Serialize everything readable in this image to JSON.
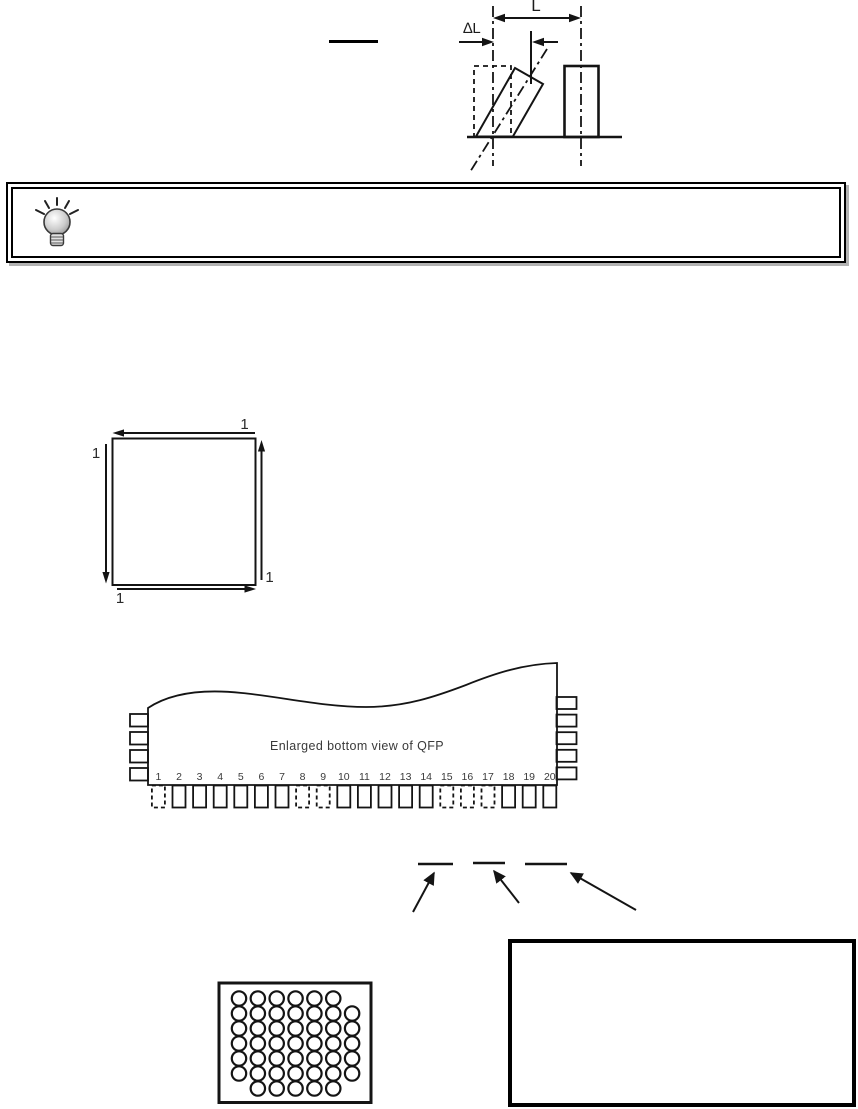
{
  "colors": {
    "ink": "#141414",
    "text": "#3a3a3a",
    "shadow": "#b3b3b3"
  },
  "figures": {
    "lead_deviation": {
      "dim_label_main": "L",
      "dim_label_delta": "∆L"
    },
    "blank_line": {
      "text": ""
    },
    "tip_box": {
      "icon": "lightbulb-icon",
      "text": ""
    },
    "sequence_square": {
      "corner_labels": {
        "top": "1",
        "left": "1",
        "right": "1",
        "bottom": "1"
      }
    },
    "qfp": {
      "caption": "Enlarged bottom view of QFP",
      "pin_numbers": [
        "1",
        "2",
        "3",
        "4",
        "5",
        "6",
        "7",
        "8",
        "9",
        "10",
        "11",
        "12",
        "13",
        "14",
        "15",
        "16",
        "17",
        "18",
        "19",
        "20"
      ],
      "dashed_pin_numbers": [
        1,
        8,
        9,
        15,
        16,
        17
      ],
      "left_side_pin_count": 4,
      "right_side_pin_count": 5
    },
    "callouts": {
      "underline_count": 3,
      "arrow_count": 3
    },
    "bga": {
      "rows": 7,
      "cols": 7,
      "missing_balls": [
        [
          1,
          7
        ],
        [
          7,
          1
        ],
        [
          7,
          7
        ]
      ]
    },
    "empty_note_box": {
      "text": ""
    }
  }
}
